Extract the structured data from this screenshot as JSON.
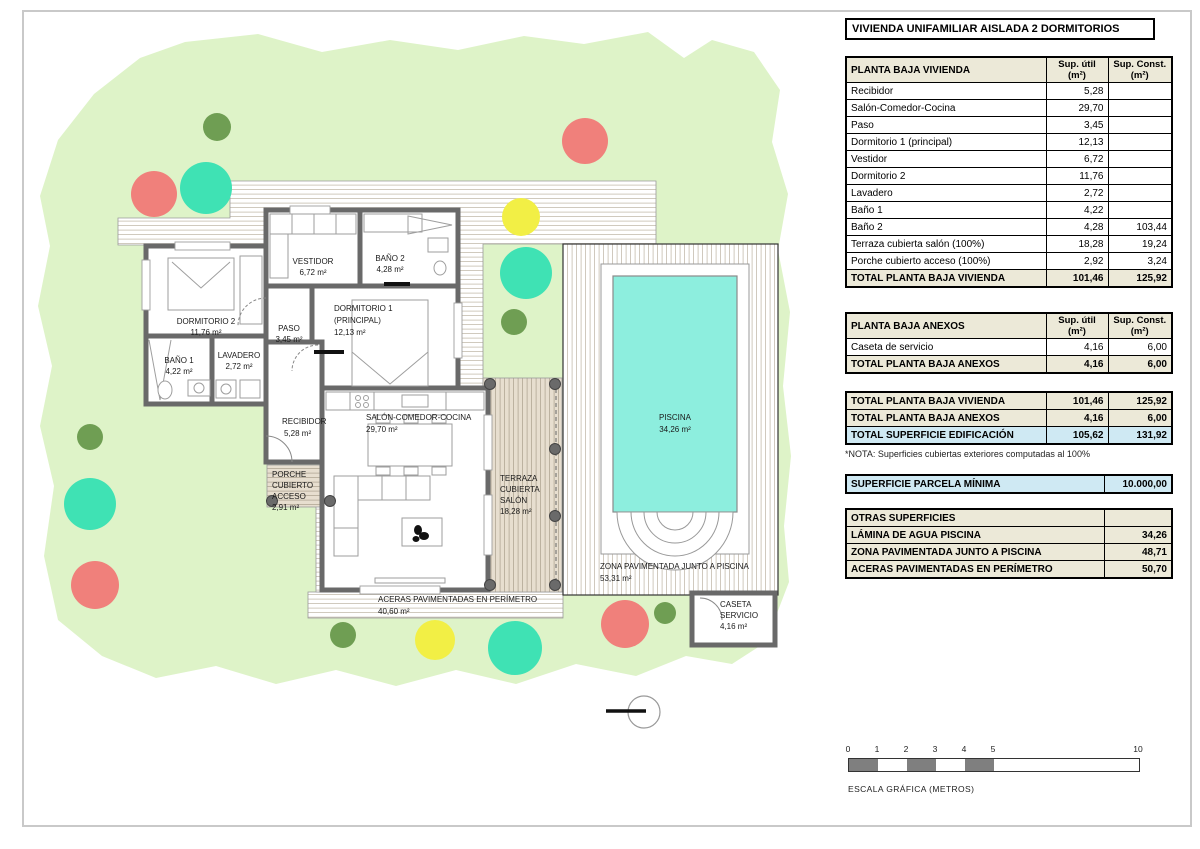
{
  "page": {
    "title": "VIVIENDA UNIFAMILIAR AISLADA 2 DORMITORIOS"
  },
  "palette": {
    "parcel": "#def3c8",
    "treeRed": "#f0807b",
    "treeTeal": "#3fe2b4",
    "treeYellow": "#f2ef45",
    "treeGreen": "#6f9e53",
    "wall": "#696969",
    "pool": "#8deede",
    "terraza": "#e7decf",
    "headerBeige": "#ece9d8",
    "highlightBlue": "#cfe9f3",
    "scaleDark": "#7f7f7f",
    "post": "#6a6a6a"
  },
  "tables": {
    "vivienda": {
      "header": "PLANTA BAJA VIVIENDA",
      "col_util_l1": "Sup. útil",
      "col_util_l2": "(m²)",
      "col_const_l1": "Sup. Const.",
      "col_const_l2": "(m²)",
      "rows": [
        {
          "name": "Recibidor",
          "util": "5,28",
          "const": ""
        },
        {
          "name": "Salón-Comedor-Cocina",
          "util": "29,70",
          "const": ""
        },
        {
          "name": "Paso",
          "util": "3,45",
          "const": ""
        },
        {
          "name": "Dormitorio 1 (principal)",
          "util": "12,13",
          "const": ""
        },
        {
          "name": "Vestidor",
          "util": "6,72",
          "const": ""
        },
        {
          "name": "Dormitorio 2",
          "util": "11,76",
          "const": ""
        },
        {
          "name": "Lavadero",
          "util": "2,72",
          "const": ""
        },
        {
          "name": "Baño 1",
          "util": "4,22",
          "const": ""
        },
        {
          "name": "Baño 2",
          "util": "4,28",
          "const": "103,44"
        },
        {
          "name": "Terraza cubierta salón (100%)",
          "util": "18,28",
          "const": "19,24"
        },
        {
          "name": "Porche cubierto acceso (100%)",
          "util": "2,92",
          "const": "3,24"
        }
      ],
      "total": {
        "name": "TOTAL PLANTA BAJA VIVIENDA",
        "util": "101,46",
        "const": "125,92"
      }
    },
    "anexos": {
      "header": "PLANTA BAJA ANEXOS",
      "col_util_l1": "Sup. útil",
      "col_util_l2": "(m²)",
      "col_const_l1": "Sup. Const.",
      "col_const_l2": "(m²)",
      "rows": [
        {
          "name": "Caseta de servicio",
          "util": "4,16",
          "const": "6,00"
        }
      ],
      "total": {
        "name": "TOTAL PLANTA BAJA ANEXOS",
        "util": "4,16",
        "const": "6,00"
      }
    },
    "resumen": {
      "rows": [
        {
          "name": "TOTAL PLANTA BAJA VIVIENDA",
          "util": "101,46",
          "const": "125,92"
        },
        {
          "name": "TOTAL PLANTA BAJA ANEXOS",
          "util": "4,16",
          "const": "6,00"
        },
        {
          "name": "TOTAL SUPERFICIE EDIFICACIÓN",
          "util": "105,62",
          "const": "131,92"
        }
      ]
    },
    "nota": "*NOTA: Superficies cubiertas exteriores computadas al 100%",
    "parcela": {
      "name": "SUPERFICIE PARCELA MÍNIMA",
      "value": "10.000,00"
    },
    "otras": {
      "header": "OTRAS SUPERFICIES",
      "rows": [
        {
          "name": "LÁMINA DE AGUA PISCINA",
          "value": "34,26"
        },
        {
          "name": "ZONA PAVIMENTADA JUNTO A PISCINA",
          "value": "48,71"
        },
        {
          "name": "ACERAS PAVIMENTADAS EN PERÍMETRO",
          "value": "50,70"
        }
      ]
    }
  },
  "plan": {
    "rooms": {
      "dormitorio2": {
        "l1": "DORMITORIO 2",
        "l2": "11,76 m²"
      },
      "bano1": {
        "l1": "BAÑO 1",
        "l2": "4,22 m²"
      },
      "lavadero": {
        "l1": "LAVADERO",
        "l2": "2,72 m²"
      },
      "paso": {
        "l1": "PASO",
        "l2": "3,45 m²"
      },
      "vestidor": {
        "l1": "VESTIDOR",
        "l2": "6,72 m²"
      },
      "bano2": {
        "l1": "BAÑO 2",
        "l2": "4,28 m²"
      },
      "dormitorio1": {
        "l1": "DORMITORIO 1",
        "l2": "(PRINCIPAL)",
        "l3": "12,13 m²"
      },
      "recibidor": {
        "l1": "RECIBIDOR",
        "l2": "5,28 m²"
      },
      "salon": {
        "l1": "SALÓN-COMEDOR-COCINA",
        "l2": "29,70 m²"
      },
      "porche": {
        "l1": "PORCHE",
        "l2": "CUBIERTO",
        "l3": "ACCESO",
        "l4": "2,91 m²"
      },
      "terraza": {
        "l1": "TERRAZA",
        "l2": "CUBIERTA",
        "l3": "SALÓN",
        "l4": "18,28 m²"
      },
      "piscina": {
        "l1": "PISCINA",
        "l2": "34,26 m²"
      },
      "zona": {
        "l1": "ZONA PAVIMENTADA JUNTO A PISCINA",
        "l2": "53,31 m²"
      },
      "caseta": {
        "l1": "CASETA",
        "l2": "SERVICIO",
        "l3": "4,16 m²"
      },
      "aceras": {
        "l1": "ACERAS PAVIMENTADAS EN PERÍMETRO",
        "l2": "40,60 m²"
      }
    }
  },
  "scalebar": {
    "ticks": [
      "0",
      "1",
      "2",
      "3",
      "4",
      "5",
      "10"
    ],
    "label": "ESCALA GRÁFICA (METROS)"
  }
}
